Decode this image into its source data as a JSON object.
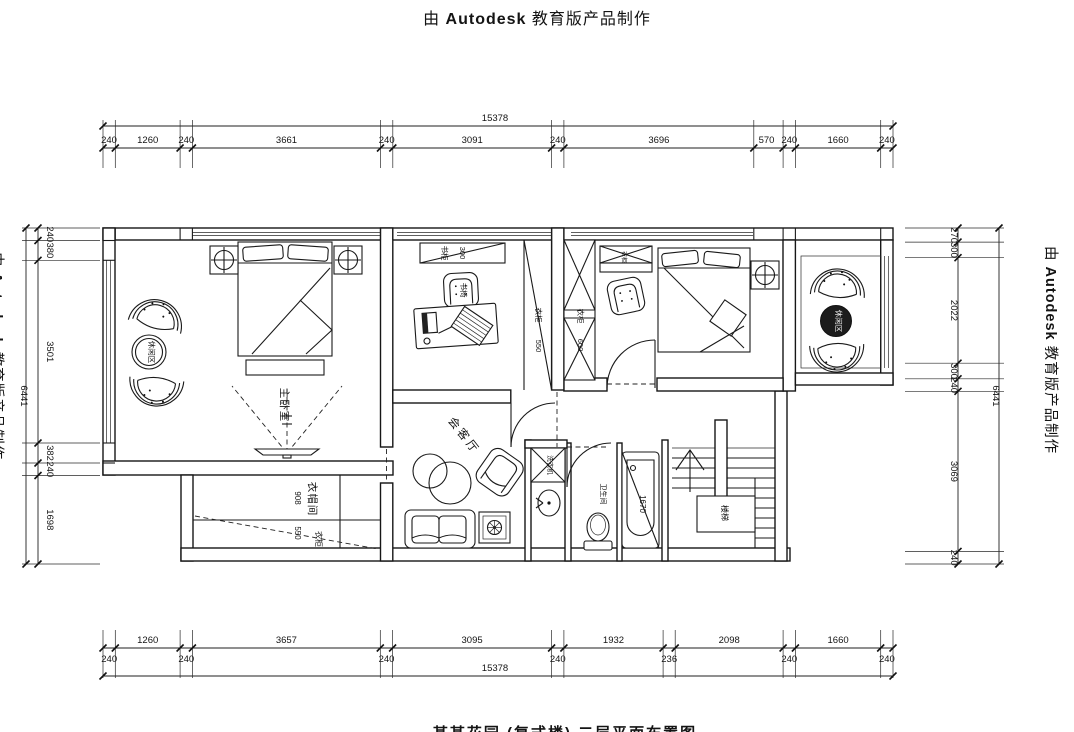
{
  "banner": {
    "prefix": "由",
    "brand": "Autodesk",
    "suffix": "教育版产品制作"
  },
  "caption_bottom": "某某花园 (复式楼) 二层平面布置图",
  "dims": {
    "top": {
      "total": "15378",
      "segments": [
        "240",
        "1260",
        "240",
        "3661",
        "240",
        "3091",
        "240",
        "3696",
        "570",
        "240",
        "1660",
        "240"
      ]
    },
    "bottom": {
      "total": "15378",
      "segments": [
        "1260",
        "3657",
        "3095",
        "1932",
        "2098",
        "1660"
      ],
      "wall_segments": [
        "240",
        "240",
        "240",
        "240",
        "236",
        "240",
        "240"
      ]
    },
    "left": {
      "total": "6441",
      "segments": [
        "240",
        "380",
        "3501",
        "382",
        "240",
        "1698"
      ]
    },
    "right": {
      "total": "6441",
      "segments": [
        "270",
        "300",
        "2022",
        "300",
        "240",
        "3069",
        "240"
      ]
    }
  },
  "rooms": {
    "master_bedroom": "主卧室",
    "leisure_left": "休闲区",
    "leisure_right": "休闲区",
    "living_room": "会客厅",
    "cloakroom": "衣帽间",
    "bathroom": "卫生间",
    "stairs": "楼梯"
  },
  "labels": {
    "bookcase": "书柜",
    "bookcase_depth": "300",
    "desk_chair": "书椅",
    "wardrobe_hall": "衣柜",
    "wardrobe_hall_depth": "550",
    "wardrobe_bedroom2": "衣柜",
    "wardrobe_bedroom2_depth": "600",
    "cabinet_bedroom2": "衣柜",
    "cloakroom_width": "908",
    "cloakroom_wardrobe": "衣柜",
    "cloakroom_wardrobe_depth": "550",
    "washing_machine": "洗衣机",
    "bathtub_length": "1670"
  }
}
